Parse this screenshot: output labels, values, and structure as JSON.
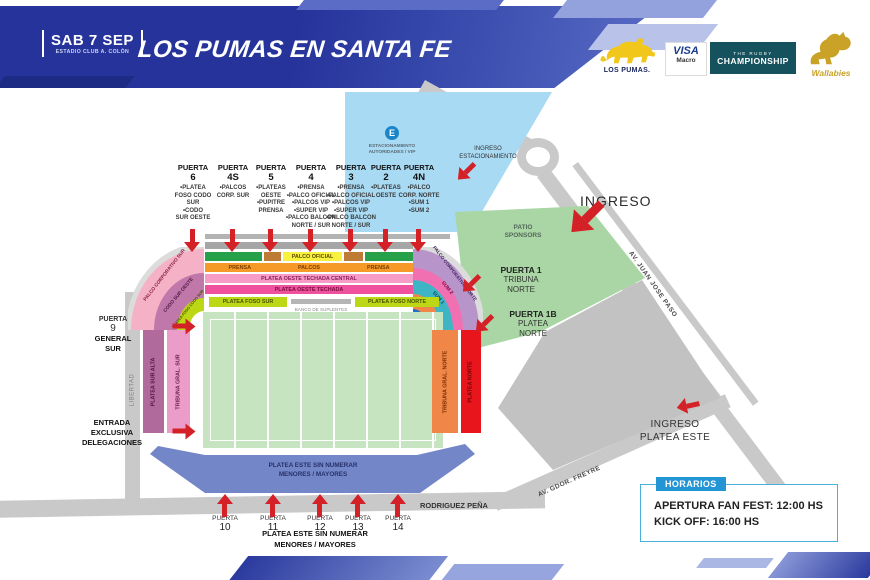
{
  "header": {
    "date": "SAB 7 SEP",
    "venue": "ESTADIO CLUB A. COLÓN",
    "title": "LOS PUMAS EN SANTA FE"
  },
  "sponsors": {
    "pumas": "LOS PUMAS.",
    "visa": "VISA",
    "macro": "Macro",
    "trc_line1": "THE RUGBY",
    "trc_line2": "CHAMPIONSHIP",
    "wallabies": "Wallabies"
  },
  "gates_top": [
    {
      "title": "PUERTA",
      "number": "6",
      "items": "•PLATEA\nFOSO CODO\nSUR\n•CODO\nSUR OESTE"
    },
    {
      "title": "PUERTA",
      "number": "4S",
      "items": "•PALCOS\nCORP. SUR"
    },
    {
      "title": "PUERTA",
      "number": "5",
      "items": "•PLATEAS\nOESTE\n•PUPITRE\nPRENSA"
    },
    {
      "title": "PUERTA",
      "number": "4",
      "items": "•PRENSA\n•PALCO OFICIAL\n•PALCOS VIP\n•SUPER VIP\n•PALCO BALCON\nNORTE / SUR"
    },
    {
      "title": "PUERTA",
      "number": "3",
      "items": "•PRENSA\n•PALCO OFICIAL\n•PALCOS VIP\n•SUPER VIP\n•PALCO BALCON\nNORTE / SUR"
    },
    {
      "title": "PUERTA",
      "number": "2",
      "items": "•PLATEAS\nOESTE"
    },
    {
      "title": "PUERTA",
      "number": "4N",
      "items": "•PALCO\nCORP. NORTE\n•SUM 1\n•SUM 2"
    }
  ],
  "gates_bottom": [
    {
      "title": "PUERTA",
      "number": "10"
    },
    {
      "title": "PUERTA",
      "number": "11"
    },
    {
      "title": "PUERTA",
      "number": "12"
    },
    {
      "title": "PUERTA",
      "number": "13"
    },
    {
      "title": "PUERTA",
      "number": "14"
    }
  ],
  "stadium": {
    "west": {
      "palco_oficial": "PALCO OFICIAL",
      "prensa_left": "PRENSA",
      "palcos": "PALCOS",
      "prensa_right": "PRENSA",
      "techada_central": "PLATEA OESTE TECHADA CENTRAL",
      "techada": "PLATEA OESTE TECHADA",
      "foso_sur": "PLATEA FOSO SUR",
      "banco": "BANCO DE SUPLENTES",
      "foso_norte": "PLATEA FOSO NORTE"
    },
    "south": {
      "alta": "PLATEA SUR ALTA",
      "tribuna": "TRIBUNA GRAL. SUR"
    },
    "north": {
      "tribuna": "TRIBUNA GRAL. NORTE",
      "platea": "PLATEA NORTE"
    },
    "east": {
      "label": "PLATEA ESTE SIN NUMERAR\nMENORES / MAYORES"
    },
    "corner_sw": {
      "palco": "PALCO CORPORATIVO SUR",
      "codo": "CODO SUR OESTE",
      "foso": "PLATEA FOSO CODO SUR"
    },
    "corner_nw": {
      "palco": "PALCO CORPORATIVO NORTE",
      "sum2": "SUM 2",
      "sum1": "SUM 1"
    }
  },
  "labels": {
    "gate9_title": "PUERTA",
    "gate9_number": "9",
    "gate9_sub": "GENERAL\nSUR",
    "entrada": "ENTRADA\nEXCLUSIVA\nDELEGACIONES",
    "gate1": "PUERTA 1",
    "gate1_sub": "TRIBUNA\nNORTE",
    "gate1b": "PUERTA 1B",
    "gate1b_sub": "PLATEA\nNORTE",
    "ingreso": "INGRESO",
    "ingreso_estacionamiento": "INGRESO\nESTACIONAMIENTO",
    "ingreso_platea_este": "INGRESO\nPLATEA ESTE",
    "patio": "PATIO\nSPONSORS",
    "parking_letter": "E",
    "parking_text": "ESTACIONAMIENTO\nAUTORIDADES / VIP",
    "bottom_note": "PLATEA ESTE SIN NUMERAR\nMENORES / MAYORES"
  },
  "streets": {
    "paso": "AV. JUAN JOSE PASO",
    "freyre": "AV. GDOR. FREYRE",
    "rodriguez": "RODRIGUEZ PEÑA",
    "libertad": "LIBERTAD"
  },
  "horarios": {
    "title": "HORARIOS",
    "line1": "APERTURA FAN FEST: 12:00 HS",
    "line2": "KICK OFF: 16:00 HS"
  },
  "colors": {
    "arrow_red": "#d42027",
    "banner_blue": "#2b3a9e",
    "parking_blue": "#a8daf3",
    "patio_green": "#a9d6a4",
    "field_green": "#c6e4c0",
    "east_blue": "#7386c8",
    "horarios_blue": "#2395d5"
  }
}
